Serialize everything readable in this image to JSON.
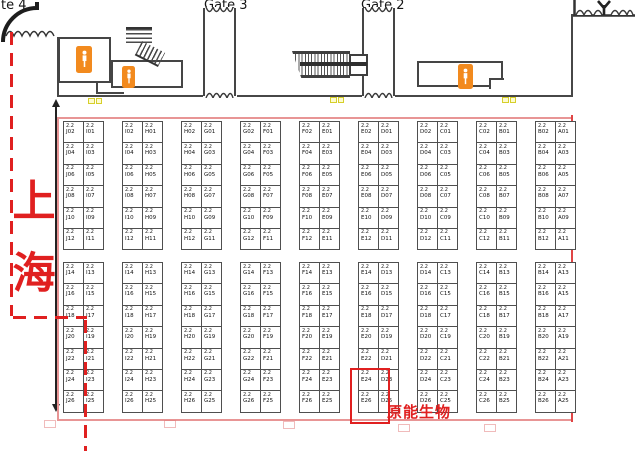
{
  "labels": {
    "gate4_partial": "te 4",
    "gate3": "Gate 3",
    "gate2": "Gate 2",
    "region": "上海",
    "company": "原能生物"
  },
  "grid": {
    "hall_prefix": "2.2",
    "sections": [
      {
        "id": "top",
        "blocks": [
          {
            "cols": [
              [
                "J02",
                "J04",
                "J06",
                "J08",
                "J10",
                "J12"
              ],
              [
                "I01",
                "I03",
                "I05",
                "I07",
                "I09",
                "I11"
              ]
            ]
          },
          {
            "cols": [
              [
                "I02",
                "I04",
                "I06",
                "I08",
                "I10",
                "I12"
              ],
              [
                "H01",
                "H03",
                "H05",
                "H07",
                "H09",
                "H11"
              ]
            ]
          },
          {
            "cols": [
              [
                "H02",
                "H04",
                "H06",
                "H08",
                "H10",
                "H12"
              ],
              [
                "G01",
                "G03",
                "G05",
                "G07",
                "G09",
                "G11"
              ]
            ]
          },
          {
            "cols": [
              [
                "G02",
                "G04",
                "G06",
                "G08",
                "G10",
                "G12"
              ],
              [
                "F01",
                "F03",
                "F05",
                "F07",
                "F09",
                "F11"
              ]
            ]
          },
          {
            "cols": [
              [
                "F02",
                "F04",
                "F06",
                "F08",
                "F10",
                "F12"
              ],
              [
                "E01",
                "E03",
                "E05",
                "E07",
                "E09",
                "E11"
              ]
            ]
          },
          {
            "cols": [
              [
                "E02",
                "E04",
                "E06",
                "E08",
                "E10",
                "E12"
              ],
              [
                "D01",
                "D03",
                "D05",
                "D07",
                "D09",
                "D11"
              ]
            ]
          },
          {
            "cols": [
              [
                "D02",
                "D04",
                "D06",
                "D08",
                "D10",
                "D12"
              ],
              [
                "C01",
                "C03",
                "C05",
                "C07",
                "C09",
                "C11"
              ]
            ]
          },
          {
            "cols": [
              [
                "C02",
                "C04",
                "C06",
                "C08",
                "C10",
                "C12"
              ],
              [
                "B01",
                "B03",
                "B05",
                "B07",
                "B09",
                "B11"
              ]
            ]
          },
          {
            "cols": [
              [
                "B02",
                "B04",
                "B06",
                "B08",
                "B10",
                "B12"
              ],
              [
                "A01",
                "A03",
                "A05",
                "A07",
                "A09",
                "A11"
              ]
            ]
          }
        ]
      },
      {
        "id": "bottom",
        "blocks": [
          {
            "cols": [
              [
                "J14",
                "J16",
                "J18",
                "J20",
                "J22",
                "J24",
                "J26"
              ],
              [
                "I13",
                "I15",
                "I17",
                "I19",
                "I21",
                "I23",
                "I25"
              ]
            ]
          },
          {
            "cols": [
              [
                "I14",
                "I16",
                "I18",
                "I20",
                "I22",
                "I24",
                "I26"
              ],
              [
                "H13",
                "H15",
                "H17",
                "H19",
                "H21",
                "H23",
                "H25"
              ]
            ]
          },
          {
            "cols": [
              [
                "H14",
                "H16",
                "H18",
                "H20",
                "H22",
                "H24",
                "H26"
              ],
              [
                "G13",
                "G15",
                "G17",
                "G19",
                "G21",
                "G23",
                "G25"
              ]
            ]
          },
          {
            "cols": [
              [
                "G14",
                "G16",
                "G18",
                "G20",
                "G22",
                "G24",
                "G26"
              ],
              [
                "F13",
                "F15",
                "F17",
                "F19",
                "F21",
                "F23",
                "F25"
              ]
            ]
          },
          {
            "cols": [
              [
                "F14",
                "F16",
                "F18",
                "F20",
                "F22",
                "F24",
                "F26"
              ],
              [
                "E13",
                "E15",
                "E17",
                "E19",
                "E21",
                "E23",
                "E25"
              ]
            ]
          },
          {
            "cols": [
              [
                "E14",
                "E16",
                "E18",
                "E20",
                "E22",
                "E24",
                "E26"
              ],
              [
                "D13",
                "D15",
                "D17",
                "D19",
                "D21",
                "D23",
                "D25"
              ]
            ]
          },
          {
            "cols": [
              [
                "D14",
                "D16",
                "D18",
                "D20",
                "D22",
                "D24",
                "D26"
              ],
              [
                "C13",
                "C15",
                "C17",
                "C19",
                "C21",
                "C23",
                "C25"
              ]
            ]
          },
          {
            "cols": [
              [
                "C14",
                "C16",
                "C18",
                "C20",
                "C22",
                "C24",
                "C26"
              ],
              [
                "B13",
                "B15",
                "B17",
                "B19",
                "B21",
                "B23",
                "B25"
              ]
            ]
          },
          {
            "cols": [
              [
                "B14",
                "B16",
                "B18",
                "B20",
                "B22",
                "B24",
                "B26"
              ],
              [
                "A13",
                "A15",
                "A17",
                "A19",
                "A21",
                "A23",
                "A25"
              ]
            ]
          }
        ]
      }
    ]
  },
  "highlight": {
    "booths": [
      "E24",
      "E26"
    ]
  },
  "icons": {
    "restroom": "person-pictogram",
    "stairs": "hatched-steps",
    "escalator": "hatched-ramp",
    "tree": "y-tree",
    "bushes": "scallop-arcs",
    "entrance": "quarter-arc"
  },
  "colors": {
    "boundary_red": "#e02020",
    "outline_pink": "#e89595",
    "right_border_red": "#e04545",
    "restroom_orange": "#f28a1e",
    "marker_yellow": "#d6cf2a",
    "booth_border": "#4f4f4f"
  }
}
